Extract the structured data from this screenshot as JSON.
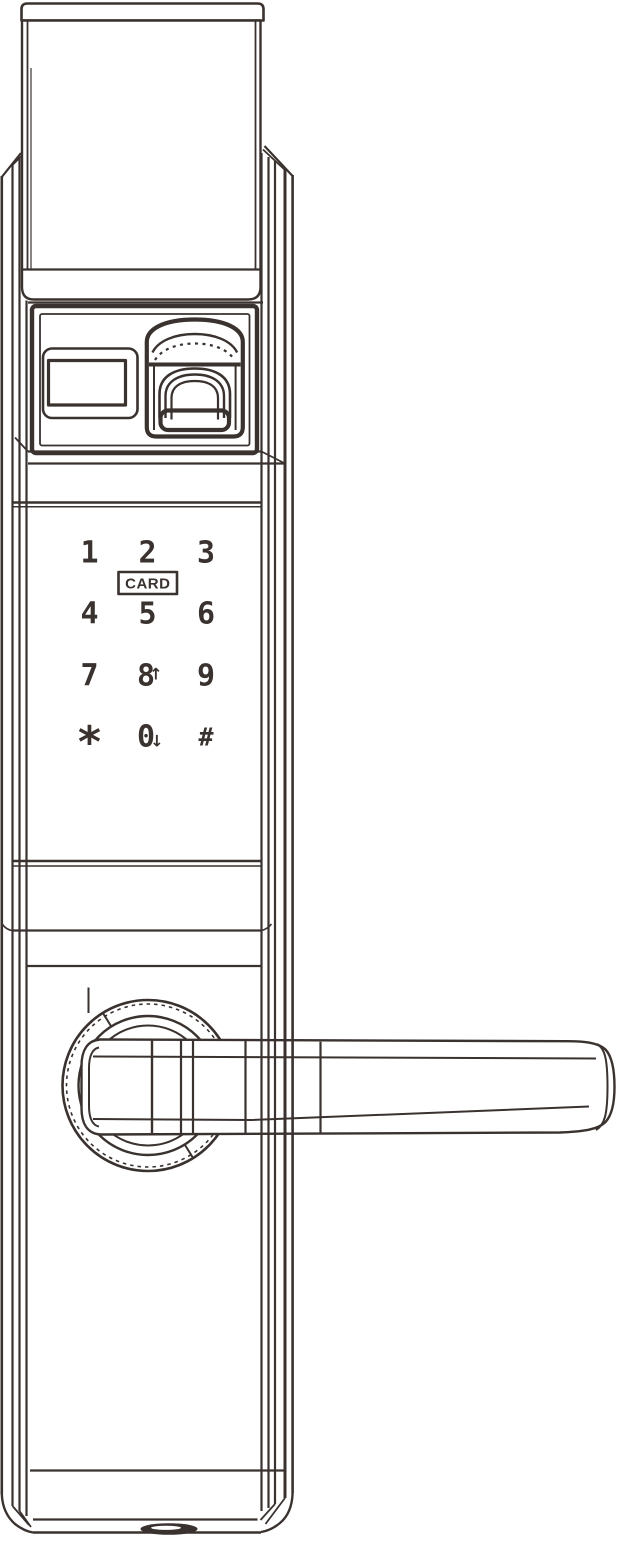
{
  "illustration": {
    "line_color": "#3a322f",
    "background_color": "#ffffff",
    "parts": [
      "top-cover",
      "status-display-window",
      "fingerprint-scanner",
      "touch-keypad",
      "card-reader-key",
      "rosette",
      "lever-handle",
      "keyhole-cover"
    ]
  },
  "keypad": {
    "keys": [
      {
        "label": "1"
      },
      {
        "label": "2"
      },
      {
        "label": "3"
      },
      {
        "label": "4"
      },
      {
        "label": "5"
      },
      {
        "label": "6"
      },
      {
        "label": "7"
      },
      {
        "label": "8",
        "modifier": "↑"
      },
      {
        "label": "9"
      },
      {
        "label": "*"
      },
      {
        "label": "0",
        "modifier": "↓"
      },
      {
        "label": "#"
      }
    ],
    "card_key": {
      "label": "CARD"
    }
  }
}
